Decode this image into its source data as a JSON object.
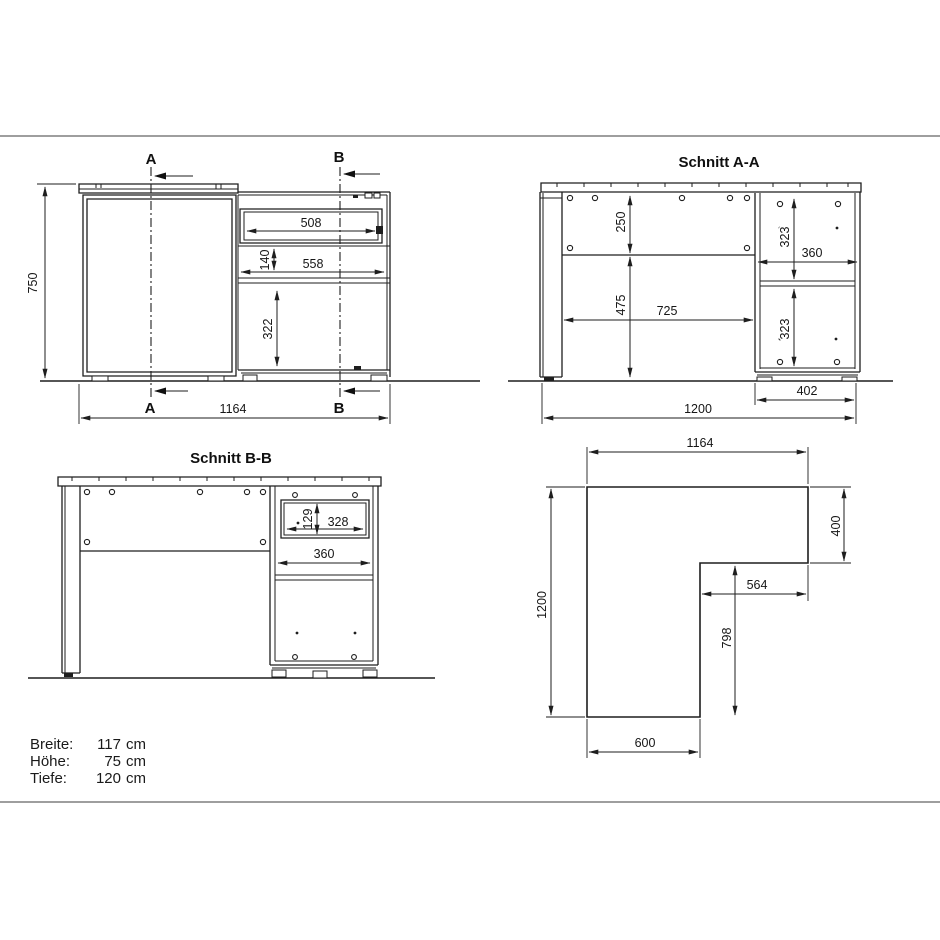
{
  "drawing": {
    "front": {
      "marker_a": "A",
      "marker_b": "B",
      "height": "750",
      "width": "1164",
      "drawer_width": "508",
      "gap_140": "140",
      "shelf_width": "558",
      "door_height": "322"
    },
    "section_aa": {
      "title": "Schnitt A-A",
      "top_250": "250",
      "left_475": "475",
      "span_725": "725",
      "upper_323": "323",
      "width_360": "360",
      "lower_323": "323",
      "cabinet_402": "402",
      "depth_1200": "1200"
    },
    "section_bb": {
      "title": "Schnitt B-B",
      "drawer_129": "129",
      "drawer_328": "328",
      "inner_360": "360"
    },
    "plan": {
      "width_1164": "1164",
      "wing_400": "400",
      "wing_564": "564",
      "side_798": "798",
      "depth_1200": "1200",
      "return_600": "600"
    },
    "specs": {
      "rows": [
        {
          "label": "Breite:",
          "value": "117",
          "unit": "cm"
        },
        {
          "label": "Höhe:",
          "value": "75",
          "unit": "cm"
        },
        {
          "label": "Tiefe:",
          "value": "120",
          "unit": "cm"
        }
      ]
    }
  }
}
